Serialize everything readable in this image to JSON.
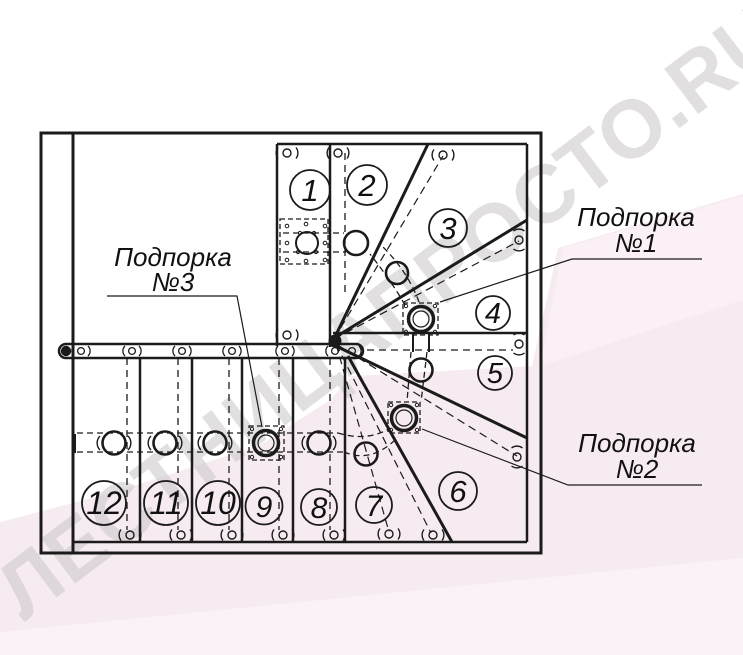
{
  "watermark": {
    "text": "ЛЕСТНИЦАПРОСТО.RU"
  },
  "drawing": {
    "type": "staircase-plan",
    "steps": [
      {
        "label": "1"
      },
      {
        "label": "2"
      },
      {
        "label": "3"
      },
      {
        "label": "4"
      },
      {
        "label": "5"
      },
      {
        "label": "6"
      },
      {
        "label": "7"
      },
      {
        "label": "8"
      },
      {
        "label": "9"
      },
      {
        "label": "10"
      },
      {
        "label": "11"
      },
      {
        "label": "12"
      }
    ],
    "supports": [
      {
        "line1": "Подпорка",
        "line2": "№1"
      },
      {
        "line1": "Подпорка",
        "line2": "№2"
      },
      {
        "line1": "Подпорка",
        "line2": "№3"
      }
    ],
    "colors": {
      "line": "#1b1b1b",
      "pink_bg": "#f7ebf2",
      "pink_light": "#fbf3f8",
      "watermark_gray": "#c9c5c8"
    }
  }
}
